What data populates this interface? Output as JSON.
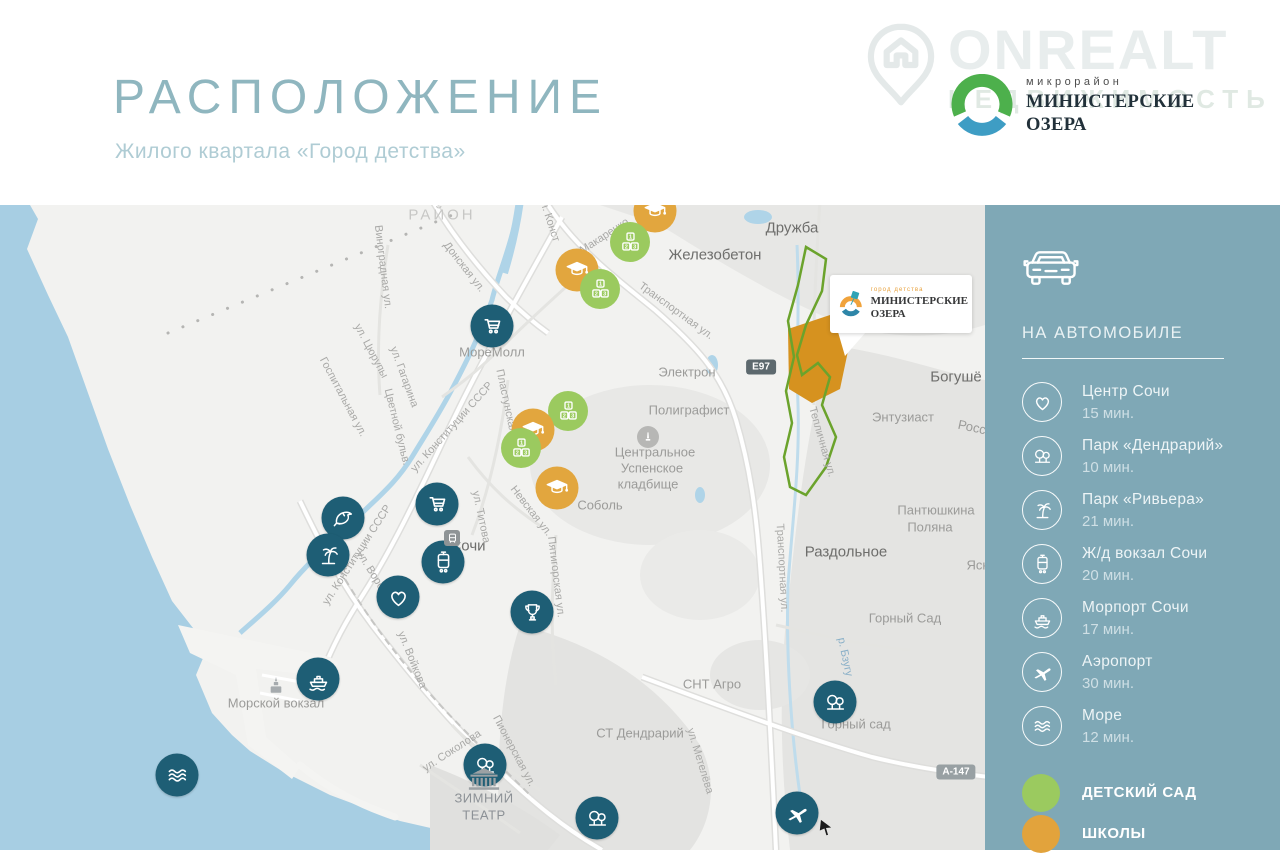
{
  "header": {
    "title": "РАСПОЛОЖЕНИЕ",
    "subtitle": "Жилого квартала «Город детства»",
    "watermark": {
      "brand": "ONREALT",
      "sub": "НЕДВИЖИМОСТЬ"
    },
    "brand": {
      "above": "микрорайон",
      "name_line1": "МИНИСТЕРСКИЕ",
      "name_line2": "ОЗЕРА"
    }
  },
  "site_card": {
    "above": "город детства",
    "name_line1": "МИНИСТЕРСКИЕ",
    "name_line2": "ОЗЕРА"
  },
  "sidebar": {
    "transport_title": "НА АВТОМОБИЛЕ",
    "items": [
      {
        "icon": "heart-icon",
        "label": "Центр Сочи",
        "time": "15 мин."
      },
      {
        "icon": "park-trees-icon",
        "label": "Парк «Дендрарий»",
        "time": "10 мин."
      },
      {
        "icon": "palm-icon",
        "label": "Парк «Ривьера»",
        "time": "21 мин."
      },
      {
        "icon": "tram-icon",
        "label": "Ж/д вокзал Сочи",
        "time": "20 мин."
      },
      {
        "icon": "ship-icon",
        "label": "Морпорт Сочи",
        "time": "17 мин."
      },
      {
        "icon": "plane-icon",
        "label": "Аэропорт",
        "time": "30 мин."
      },
      {
        "icon": "waves-icon",
        "label": "Море",
        "time": "12 мин."
      }
    ],
    "legend": [
      {
        "color": "#9BCA5F",
        "label": "ДЕТСКИЙ САД"
      },
      {
        "color": "#E2A33C",
        "label": "ШКОЛЫ"
      }
    ]
  },
  "map": {
    "kinder_digits": [
      "1",
      "2",
      "3"
    ],
    "markers": [
      {
        "c": "school",
        "i": "grad-cap-icon",
        "x": 655,
        "y": 6
      },
      {
        "c": "school",
        "i": "grad-cap-icon",
        "x": 577,
        "y": 65
      },
      {
        "c": "kinder",
        "i": "kids-blocks-icon",
        "x": 630,
        "y": 37
      },
      {
        "c": "kinder",
        "i": "kids-blocks-icon",
        "x": 600,
        "y": 84
      },
      {
        "c": "poi",
        "i": "cart-icon",
        "x": 492,
        "y": 121
      },
      {
        "c": "kinder",
        "i": "kids-blocks-icon",
        "x": 568,
        "y": 206
      },
      {
        "c": "school",
        "i": "grad-cap-icon",
        "x": 533,
        "y": 225
      },
      {
        "c": "kinder",
        "i": "kids-blocks-icon",
        "x": 521,
        "y": 243
      },
      {
        "c": "school",
        "i": "grad-cap-icon",
        "x": 557,
        "y": 283
      },
      {
        "c": "poi",
        "i": "cart-icon",
        "x": 437,
        "y": 299
      },
      {
        "c": "poi",
        "i": "dolphin-icon",
        "x": 343,
        "y": 313
      },
      {
        "c": "poi",
        "i": "palm-icon",
        "x": 328,
        "y": 350
      },
      {
        "c": "poi",
        "i": "tram-icon",
        "x": 443,
        "y": 357
      },
      {
        "c": "poi",
        "i": "heart-icon",
        "x": 398,
        "y": 392
      },
      {
        "c": "poi",
        "i": "trophy-icon",
        "x": 532,
        "y": 407
      },
      {
        "c": "poi",
        "i": "ship-icon",
        "x": 318,
        "y": 474
      },
      {
        "c": "poi",
        "i": "waves-icon",
        "x": 177,
        "y": 570
      },
      {
        "c": "poi",
        "i": "park-trees-icon",
        "x": 485,
        "y": 560
      },
      {
        "c": "poi",
        "i": "park-trees-icon",
        "x": 597,
        "y": 613
      },
      {
        "c": "poi",
        "i": "park-trees-icon",
        "x": 835,
        "y": 497
      },
      {
        "c": "poi",
        "i": "plane-icon",
        "x": 797,
        "y": 608
      },
      {
        "c": "gcirc",
        "i": "monument-icon",
        "x": 648,
        "y": 232
      },
      {
        "c": "gsq",
        "i": "station-icon",
        "x": 452,
        "y": 333
      },
      {
        "c": "bld",
        "i": "seaport-building-icon",
        "x": 276,
        "y": 481
      },
      {
        "c": "bld-theater",
        "i": "theater-icon",
        "x": 484,
        "y": 575
      },
      {
        "c": "arrow",
        "i": "arrow-icon",
        "x": 826,
        "y": 623,
        "r": 10
      }
    ],
    "labels": [
      {
        "t": "РАЙОН",
        "x": 442,
        "y": 10,
        "c": "area"
      },
      {
        "t": "Дружба",
        "x": 792,
        "y": 23,
        "c": "town"
      },
      {
        "t": "Железобетон",
        "x": 715,
        "y": 50,
        "c": "town"
      },
      {
        "t": "Раздольное",
        "x": 846,
        "y": 347,
        "c": "town"
      },
      {
        "t": "Богушё",
        "x": 956,
        "y": 172,
        "c": "town"
      },
      {
        "t": "Сочи",
        "x": 468,
        "y": 341,
        "c": "town"
      },
      {
        "t": "МореМолл",
        "x": 492,
        "y": 147,
        "c": "place"
      },
      {
        "t": "Электрон",
        "x": 687,
        "y": 167,
        "c": "place"
      },
      {
        "t": "Полиграфист",
        "x": 689,
        "y": 205,
        "c": "place"
      },
      {
        "t": "Центральное",
        "x": 655,
        "y": 247,
        "c": "place"
      },
      {
        "t": "Успенское",
        "x": 652,
        "y": 263,
        "c": "place"
      },
      {
        "t": "кладбище",
        "x": 648,
        "y": 279,
        "c": "place"
      },
      {
        "t": "Соболь",
        "x": 600,
        "y": 300,
        "c": "place"
      },
      {
        "t": "Энтузиаст",
        "x": 903,
        "y": 212,
        "c": "place"
      },
      {
        "t": "Росс",
        "x": 972,
        "y": 222,
        "c": "place",
        "r": 12
      },
      {
        "t": "Пантюшкина",
        "x": 936,
        "y": 305,
        "c": "place"
      },
      {
        "t": "Поляна",
        "x": 930,
        "y": 322,
        "c": "place"
      },
      {
        "t": "Ясн",
        "x": 978,
        "y": 360,
        "c": "place"
      },
      {
        "t": "Горный Сад",
        "x": 905,
        "y": 413,
        "c": "place"
      },
      {
        "t": "Горный сад",
        "x": 856,
        "y": 519,
        "c": "place"
      },
      {
        "t": "СНТ Агро",
        "x": 712,
        "y": 479,
        "c": "place"
      },
      {
        "t": "СТ Дендрарий",
        "x": 640,
        "y": 528,
        "c": "place"
      },
      {
        "t": "Морской вокзал",
        "x": 276,
        "y": 498,
        "c": "place"
      },
      {
        "t": "ЗИМНИЙ",
        "x": 484,
        "y": 593,
        "c": "poiname"
      },
      {
        "t": "ТЕАТР",
        "x": 484,
        "y": 610,
        "c": "poiname"
      },
      {
        "t": "ул. Макаренко",
        "x": 597,
        "y": 36,
        "c": "street",
        "r": -33
      },
      {
        "t": "Донская ул.",
        "x": 464,
        "y": 62,
        "c": "street",
        "r": 52
      },
      {
        "t": "ул. Конст",
        "x": 549,
        "y": 14,
        "c": "street",
        "r": 72
      },
      {
        "t": "Транспортная ул.",
        "x": 676,
        "y": 106,
        "c": "street",
        "r": 36
      },
      {
        "t": "Транспортная ул.",
        "x": 782,
        "y": 363,
        "c": "street",
        "r": 87
      },
      {
        "t": "Тепличная ул.",
        "x": 822,
        "y": 237,
        "c": "street",
        "r": 74
      },
      {
        "t": "Пластунская ул.",
        "x": 508,
        "y": 205,
        "c": "street",
        "r": 78
      },
      {
        "t": "ул. Конституции СССР",
        "x": 452,
        "y": 222,
        "c": "street",
        "r": -48
      },
      {
        "t": "ул. Конституции СССР",
        "x": 357,
        "y": 350,
        "c": "street",
        "r": -57
      },
      {
        "t": "ул. Гагарина",
        "x": 404,
        "y": 172,
        "c": "street",
        "r": 70
      },
      {
        "t": "ул. Цюрупы",
        "x": 371,
        "y": 146,
        "c": "street",
        "r": 62
      },
      {
        "t": "Госпитальная ул.",
        "x": 343,
        "y": 192,
        "c": "street",
        "r": 62
      },
      {
        "t": "Цветной бульв.",
        "x": 397,
        "y": 222,
        "c": "street",
        "r": 76
      },
      {
        "t": "Виноградная ул.",
        "x": 383,
        "y": 62,
        "c": "street",
        "r": 83
      },
      {
        "t": "ул. Титова",
        "x": 481,
        "y": 312,
        "c": "street",
        "r": 78
      },
      {
        "t": "Невская ул.",
        "x": 531,
        "y": 306,
        "c": "street",
        "r": 52
      },
      {
        "t": "ул. Воровского",
        "x": 379,
        "y": 379,
        "c": "street",
        "r": 58
      },
      {
        "t": "ул. Войкова",
        "x": 412,
        "y": 455,
        "c": "street",
        "r": 68
      },
      {
        "t": "ул. Соколова",
        "x": 452,
        "y": 546,
        "c": "street",
        "r": -33
      },
      {
        "t": "Пионерская ул.",
        "x": 514,
        "y": 546,
        "c": "street",
        "r": 62
      },
      {
        "t": "ул. Метелёва",
        "x": 700,
        "y": 556,
        "c": "street",
        "r": 73
      },
      {
        "t": "Пятигорская ул.",
        "x": 556,
        "y": 372,
        "c": "street",
        "r": 83
      },
      {
        "t": "р. Бзугу",
        "x": 845,
        "y": 452,
        "c": "water",
        "r": 78
      }
    ],
    "badges": [
      {
        "t": "E97",
        "x": 761,
        "y": 162,
        "s": "dark"
      },
      {
        "t": "А-147",
        "x": 956,
        "y": 567,
        "s": "gray"
      }
    ]
  }
}
